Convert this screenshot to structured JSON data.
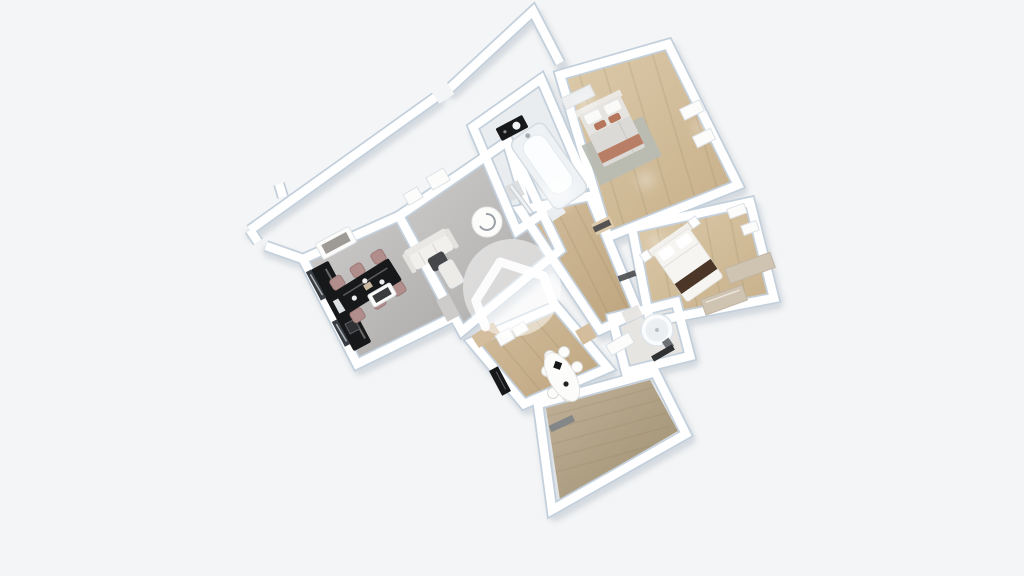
{
  "meta": {
    "title": "3D floor plan rendering, top-down dollhouse view, rotated",
    "canvas": {
      "width": 1024,
      "height": 576
    },
    "visible_text": "none"
  },
  "scene": {
    "background": "#f4f5f6",
    "colors": {
      "wall": "#ffffff",
      "wall_edge": "#c3d0dc",
      "wall_shadow": "#93a3b1",
      "floor_gray_light": "#cecccb",
      "floor_gray_dark": "#acaaa9",
      "wood_light": "#ddcbab",
      "wood_dark": "#c6ae88",
      "wood2_light": "#d3bd9c",
      "wood2_dark": "#bda47e",
      "deck_light": "#c1b29a",
      "deck_dark": "#9e8e70",
      "bath_floor": "#eaedef",
      "shower_floor": "#e7e5e2",
      "black_furniture": "#17181a",
      "chair_mauve": "#b18e8c",
      "terracotta": "#b5765c",
      "dark_brown": "#4b3627",
      "beige": "#cfc3b1",
      "sofa_light": "#f1f0ed",
      "dark_gray": "#45474a",
      "white_furniture": "#fcfcfb",
      "glass_dark": "#393e44",
      "rug_gray": "#b7bbb4",
      "threshold_dark": "#3e4042",
      "balcony_threshold": "#7a8187",
      "watermark_fill": "rgba(255,255,255,0.5)",
      "watermark_stroke": "rgba(255,255,255,0.92)"
    },
    "watermark": {
      "shape": "house-outline-in-circle",
      "position": "center"
    },
    "rooms": [
      {
        "id": "entry",
        "name": "entry vestibule / building walls",
        "floor": "none",
        "furniture": [
          "exterior wall segments",
          "diagonal wall",
          "door gap"
        ]
      },
      {
        "id": "kitchen",
        "name": "kitchen-dining",
        "floor": "gray",
        "furniture": [
          "black kitchen counter",
          "two dark glass windows",
          "white buffet",
          "black gloss dining table",
          "six dusty-rose chairs",
          "white tableware"
        ]
      },
      {
        "id": "living",
        "name": "living room",
        "floor": "gray",
        "furniture": [
          "light sofa",
          "dark gray armchair",
          "white chaise",
          "glass coffee table",
          "two wall frames",
          "round white disc lamp",
          "white cabinets",
          "entry door leaf"
        ]
      },
      {
        "id": "bathroom",
        "name": "bathroom",
        "floor": "light",
        "furniture": [
          "white bathtub",
          "black vanity with sink",
          "divider wall"
        ]
      },
      {
        "id": "bedroom1",
        "name": "bedroom 1",
        "floor": "wood",
        "furniture": [
          "double bed gray duvet",
          "terracotta cushions and runner",
          "gray rug",
          "wardrobe",
          "two windows"
        ]
      },
      {
        "id": "hallway",
        "name": "hallway",
        "floor": "wood",
        "furniture": [
          "door thresholds"
        ]
      },
      {
        "id": "bedroom2",
        "name": "bedroom 2",
        "floor": "wood",
        "furniture": [
          "white double bed",
          "dark brown runner",
          "two nightstands",
          "beige corner dresser",
          "two windows"
        ]
      },
      {
        "id": "shower",
        "name": "shower room",
        "floor": "light",
        "furniture": [
          "round shower cabin",
          "white washbasin cabinet",
          "dark mat"
        ]
      },
      {
        "id": "dining",
        "name": "dining room",
        "floor": "wood",
        "furniture": [
          "white oval table",
          "six white chairs",
          "black table decor",
          "black sideboard",
          "balcony door"
        ]
      },
      {
        "id": "balcony",
        "name": "balcony terrace",
        "floor": "deck",
        "furniture": []
      }
    ]
  }
}
